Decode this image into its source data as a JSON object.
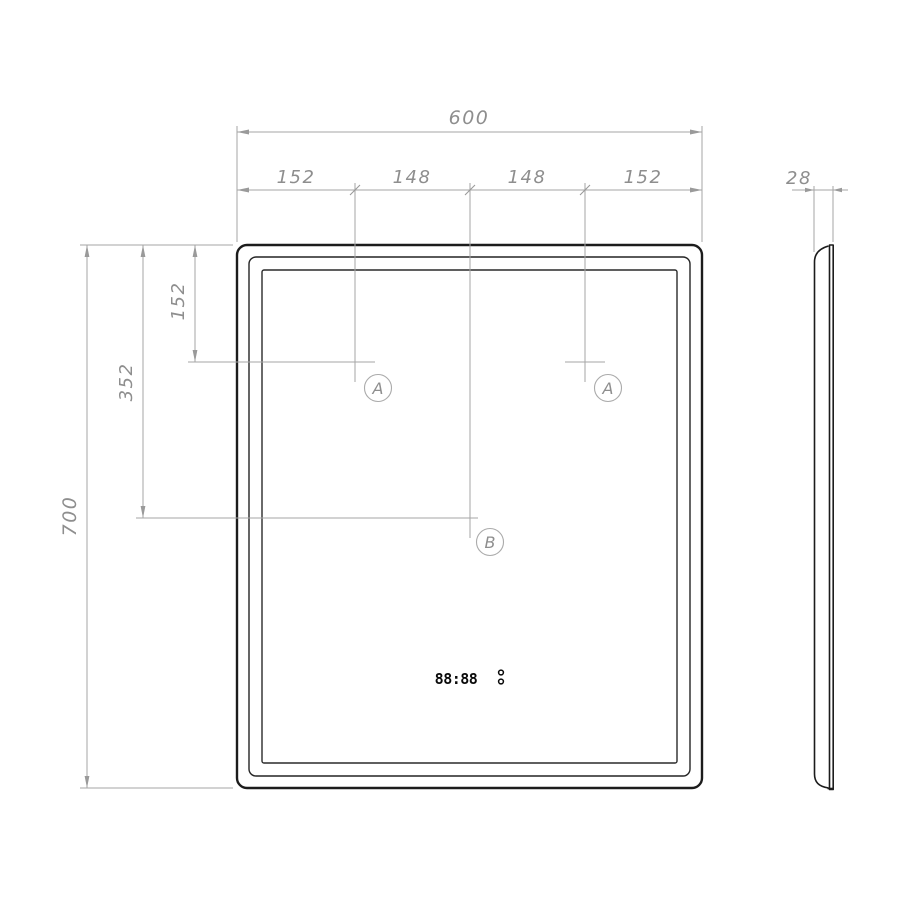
{
  "drawing_title": "mirror-technical-drawing",
  "dims": {
    "w_total": "600",
    "w_segments": [
      "152",
      "148",
      "148",
      "152"
    ],
    "h_total": "700",
    "h_mid": "352",
    "h_top": "152",
    "depth": "28"
  },
  "callouts": {
    "a_left": "A",
    "a_right": "A",
    "b": "B"
  },
  "front_view": {
    "clock_display": "88:88"
  },
  "colors": {
    "object_line": "#1c1c1c",
    "dimension_line": "#a6a6a6",
    "dimension_text": "#8e8e8e",
    "display_text": "#0a0a0a",
    "background": "#ffffff"
  }
}
